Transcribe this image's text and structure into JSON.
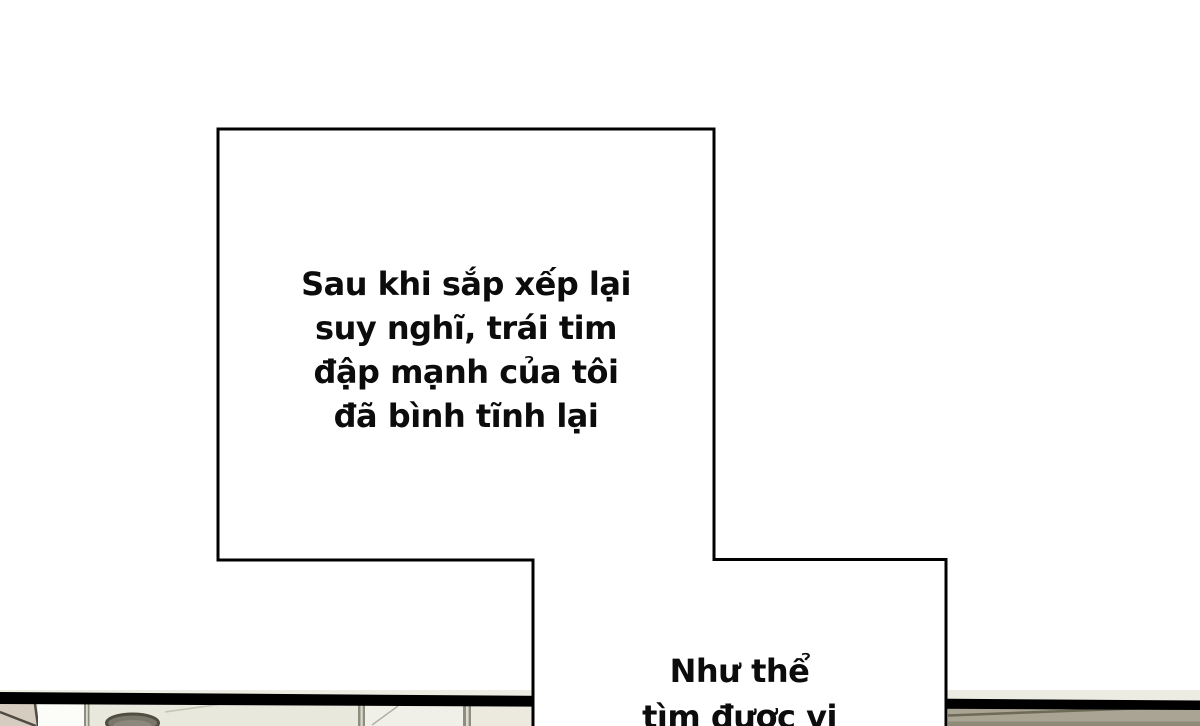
{
  "page": {
    "width": 1200,
    "height": 726,
    "background": "#ffffff",
    "kind": "comic-page"
  },
  "panel": {
    "caption_boxes": [
      {
        "name": "caption-box-1",
        "lines": [
          "Sau khi sắp xếp lại",
          "suy nghĩ, trái tim",
          "đập mạnh của tôi",
          "đã bình tĩnh lại"
        ]
      },
      {
        "name": "caption-box-2",
        "lines": [
          "Như thể",
          "tìm được vị"
        ]
      }
    ],
    "colors": {
      "ink": "#0c0c0c",
      "box_fill": "#ffffff",
      "box_stroke": "#000000",
      "panel_band": "#000000",
      "scene_base": "#edecE3",
      "wall_beige": "#d6ccbf",
      "wall_gap_white": "#fcfcf9",
      "frame_line": "#8e8e80",
      "pot_rim": "#4f4e40",
      "pot_fill": "#78776a",
      "counter_right": "#a9a493",
      "counter_edge": "#6e6a58",
      "counter_shadow": "#8f8b79"
    }
  }
}
